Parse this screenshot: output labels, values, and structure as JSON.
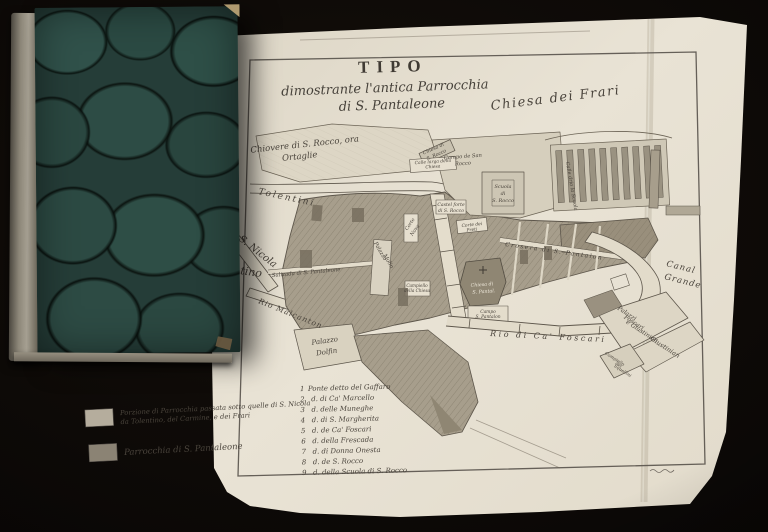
{
  "scene": {
    "background_color": "#0b0806",
    "book": {
      "cover_color": "#253d38",
      "spine_color": "#9a9486"
    },
    "paper_color": "#e8e2d4",
    "ink_color": "#4a443c"
  },
  "map": {
    "title": "TIPO",
    "subtitle_line1": "dimostrante l'antica Parrocchia",
    "subtitle_line2": "di S. Pantaleone",
    "labels": {
      "chiovere_1": "Chiovere di S. Rocco, ora",
      "chiovere_2": "Ortaglie",
      "tolentini": "Tolentini",
      "rio_s_nicola": "di S. Nicola",
      "tino": "tino",
      "chiesa_frari": "Chiesa dei Frari",
      "campo_s_rocco_1": "Campo de San",
      "campo_s_rocco_2": "Rocco",
      "chiesa_s_rocco_1": "Chiesa di",
      "chiesa_s_rocco_2": "S. Rocco",
      "calle_larga_1": "Calle larga della",
      "calle_larga_2": "Chiesa",
      "scuola_1": "Scuola",
      "scuola_2": "di",
      "scuola_3": "S. Rocco",
      "castel_1": "Castel forte",
      "castel_2": "di S. Rocco",
      "calle_drio": "Calle drio la Scuola",
      "corte_nova_1": "Corte",
      "corte_nova_2": "Nova",
      "palazzo_molin_1": "Palazzo",
      "palazzo_molin_2": "Molin",
      "corte_preti_1": "Corte dei",
      "corte_preti_2": "Preti",
      "crosera": "Crosera di S. Pantalon",
      "salizada": "Salizada di S. Pantaleone",
      "chiesa_pant_1": "Chiesa di",
      "chiesa_pant_2": "S. Pantal.",
      "campiello_chiesa_1": "Campiello",
      "campiello_chiesa_2": "della Chiesa",
      "campo_pant_1": "Campo",
      "campo_pant_2": "S. Pantalon",
      "rio_malcanton": "Rio Malcanton",
      "palazzo_dolfin_1": "Palazzo",
      "palazzo_dolfin_2": "Dolfin",
      "rio_foscari": "Rio di Ca' Foscari",
      "canal_grande_1": "Canal",
      "canal_grande_2": "Grande",
      "palazzi_foscari_1": "Palazzi",
      "palazzi_foscari_2": "Foscari",
      "palazzi_foscari_3": "e Giustinian",
      "giustinian": "Giustinian",
      "campiello_squellini_1": "Campiello",
      "campiello_squellini_2": "dei",
      "campiello_squellini_3": "Squellini"
    },
    "legend": {
      "items": [
        {
          "swatch_color": "#b5ad9d",
          "line1": "Porzione di Parrocchia passata sotto quelle di S. Nicola",
          "line2": "da Tolentino, del Carmine, e dei Frari"
        },
        {
          "swatch_color": "#8b8374",
          "line1": "Parrocchia di S. Pantaleone",
          "line2": ""
        }
      ]
    },
    "bridge_list": [
      {
        "num": "1",
        "label": "Ponte detto del Gaffaro"
      },
      {
        "num": "2",
        "label": "d. di Ca' Marcello"
      },
      {
        "num": "3",
        "label": "d. delle Muneghe"
      },
      {
        "num": "4",
        "label": "d. di S. Margherita"
      },
      {
        "num": "5",
        "label": "d. de Ca' Foscari"
      },
      {
        "num": "6",
        "label": "d. della Frescada"
      },
      {
        "num": "7",
        "label": "d. di Donna Onesta"
      },
      {
        "num": "8",
        "label": "d. de S. Rocco"
      },
      {
        "num": "9",
        "label": "d. della Scuola di S. Rocco"
      }
    ]
  }
}
